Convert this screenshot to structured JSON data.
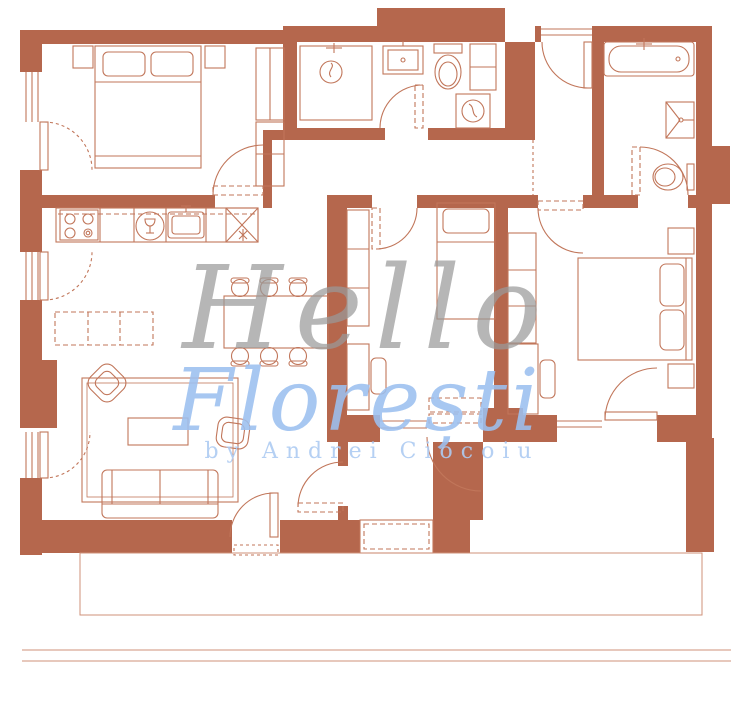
{
  "watermark": {
    "line1": "Hello",
    "line2": "Florești",
    "byline": "by Andrei Ciocoiu"
  },
  "colors": {
    "wall": "#b5674d",
    "line": "#c1765a",
    "line_light": "#cf9179",
    "watermark_gray": "#9a9a9a",
    "watermark_blue": "#9cc0f0",
    "watermark_byline_blue": "#aecbf2",
    "background": "#ffffff"
  },
  "icons": {
    "double-bed-icon": "double bed with two pillows",
    "single-bed-icon": "single bed with pillow",
    "stove-icon": "four-burner cooktop",
    "dishwasher-icon": "round dishwasher with wine glass",
    "kitchen-sink-icon": "kitchen sink with faucet",
    "fridge-icon": "crossed square with asterisk",
    "dining-table-icon": "rectangular table with six chairs",
    "sofa-icon": "three-seat sofa",
    "armchair-icon": "rotated armchair",
    "coffee-table-icon": "coffee table",
    "pouf-icon": "pouf",
    "rug-icon": "area rug",
    "sideboard-icon": "dashed sideboard",
    "wardrobe-icon": "wardrobe with shelves",
    "desk-icon": "desk with chair",
    "nightstand-icon": "nightstand",
    "shower-icon": "shower head with drain",
    "washbasin-icon": "washbasin",
    "toilet-icon": "toilet with tank",
    "washing-machine-icon": "washing machine with drum",
    "bathtub-icon": "bathtub with faucet",
    "door-icon": "door leaf with swing arc",
    "window-icon": "window frame lines",
    "terrace-icon": "terrace outline"
  }
}
